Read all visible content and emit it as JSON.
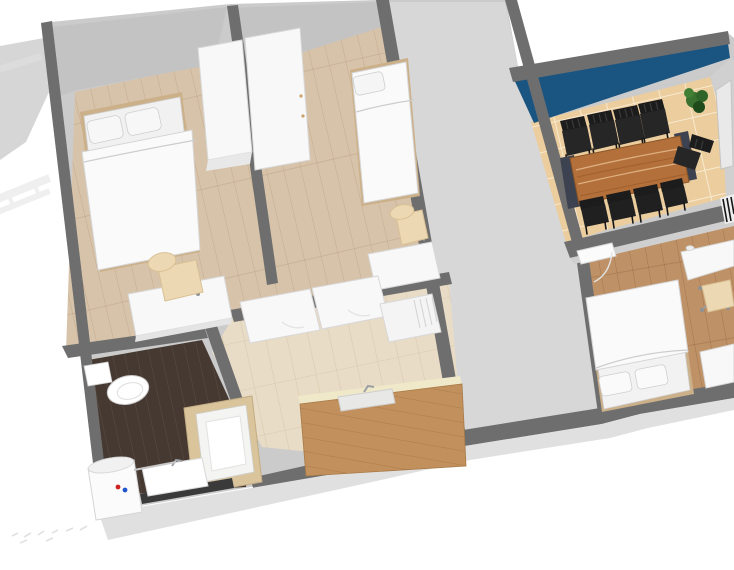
{
  "scene": {
    "type": "3d-floor-plan-render",
    "description": "Aerial 3D rendering of an apartment, viewed at an angle from above with no ceiling",
    "rooms": [
      {
        "name": "bedroom-left",
        "floor": "light wood planks",
        "furniture": [
          "double bed with two pillows",
          "tall white wardrobe",
          "white desk",
          "beige office chair"
        ]
      },
      {
        "name": "bedroom-middle",
        "floor": "light wood planks",
        "furniture": [
          "single bed with pillow",
          "tall white wardrobe",
          "white desk",
          "beige office chair",
          "white door"
        ]
      },
      {
        "name": "hallway",
        "floor": "plain gray",
        "furniture": []
      },
      {
        "name": "dining-room",
        "floor": "beige ceramic tile",
        "accent_wall": "dark blue",
        "furniture": [
          "long wooden dining table",
          "9 black slat-back chairs",
          "2 dark bench ends",
          "potted plant",
          "striped radiator",
          "door"
        ]
      },
      {
        "name": "bedroom-right",
        "floor": "medium wood planks",
        "furniture": [
          "double bed with two pillows",
          "white desk",
          "beige swivel chair",
          "white dresser",
          "white door"
        ]
      },
      {
        "name": "kitchen",
        "floor": "pale tile",
        "furniture": [
          "oak counter with sink and faucet",
          "white cabinet row",
          "refrigerator with vent grill"
        ]
      },
      {
        "name": "bathroom",
        "floor": "dark wood planks",
        "furniture": [
          "toilet",
          "shower stall",
          "water heater cylinder",
          "white sink"
        ]
      }
    ],
    "dining_chairs_count": 9,
    "exterior": [
      "faint stair railing outside north-west corner",
      "faint annotation marks on ground at south-west"
    ]
  },
  "colors": {
    "outside": "#ffffff",
    "wall_top": "#6e6e6e",
    "wall_face": "#cbcbcb",
    "wall_face_dark": "#c3c3c3",
    "wall_face_light": "#e0e0e0",
    "hallway_floor": "#d7d7d7",
    "floor_wood_light": "#d7c3a9",
    "floor_wood_medium": "#bf9166",
    "floor_wood_dark": "#463931",
    "tile_dining": "#eccd9e",
    "tile_kitchen": "#e9dcc6",
    "blue_wall": "#1a5480",
    "table_wood": "#b4703a",
    "bench_dark": "#3d4250",
    "chair_black": "#1c1c1c",
    "chair_seat_black": "#262626",
    "plant_green": "#3a7030",
    "furniture_white": "#f8f8f8",
    "bed_white": "#fafafa",
    "bed_frame_tan": "#cbb089",
    "chair_beige": "#ecd9b4",
    "counter_oak": "#c1905c",
    "counter_backstrip": "#efe8c9",
    "shower_frame": "#d9c49c",
    "radiator_dark": "#151515",
    "heater_red_dot": "#cc2222",
    "heater_blue_dot": "#2255cc",
    "exterior_wedge": "#d6d6d6",
    "rail_gray": "#e2e2e2"
  }
}
